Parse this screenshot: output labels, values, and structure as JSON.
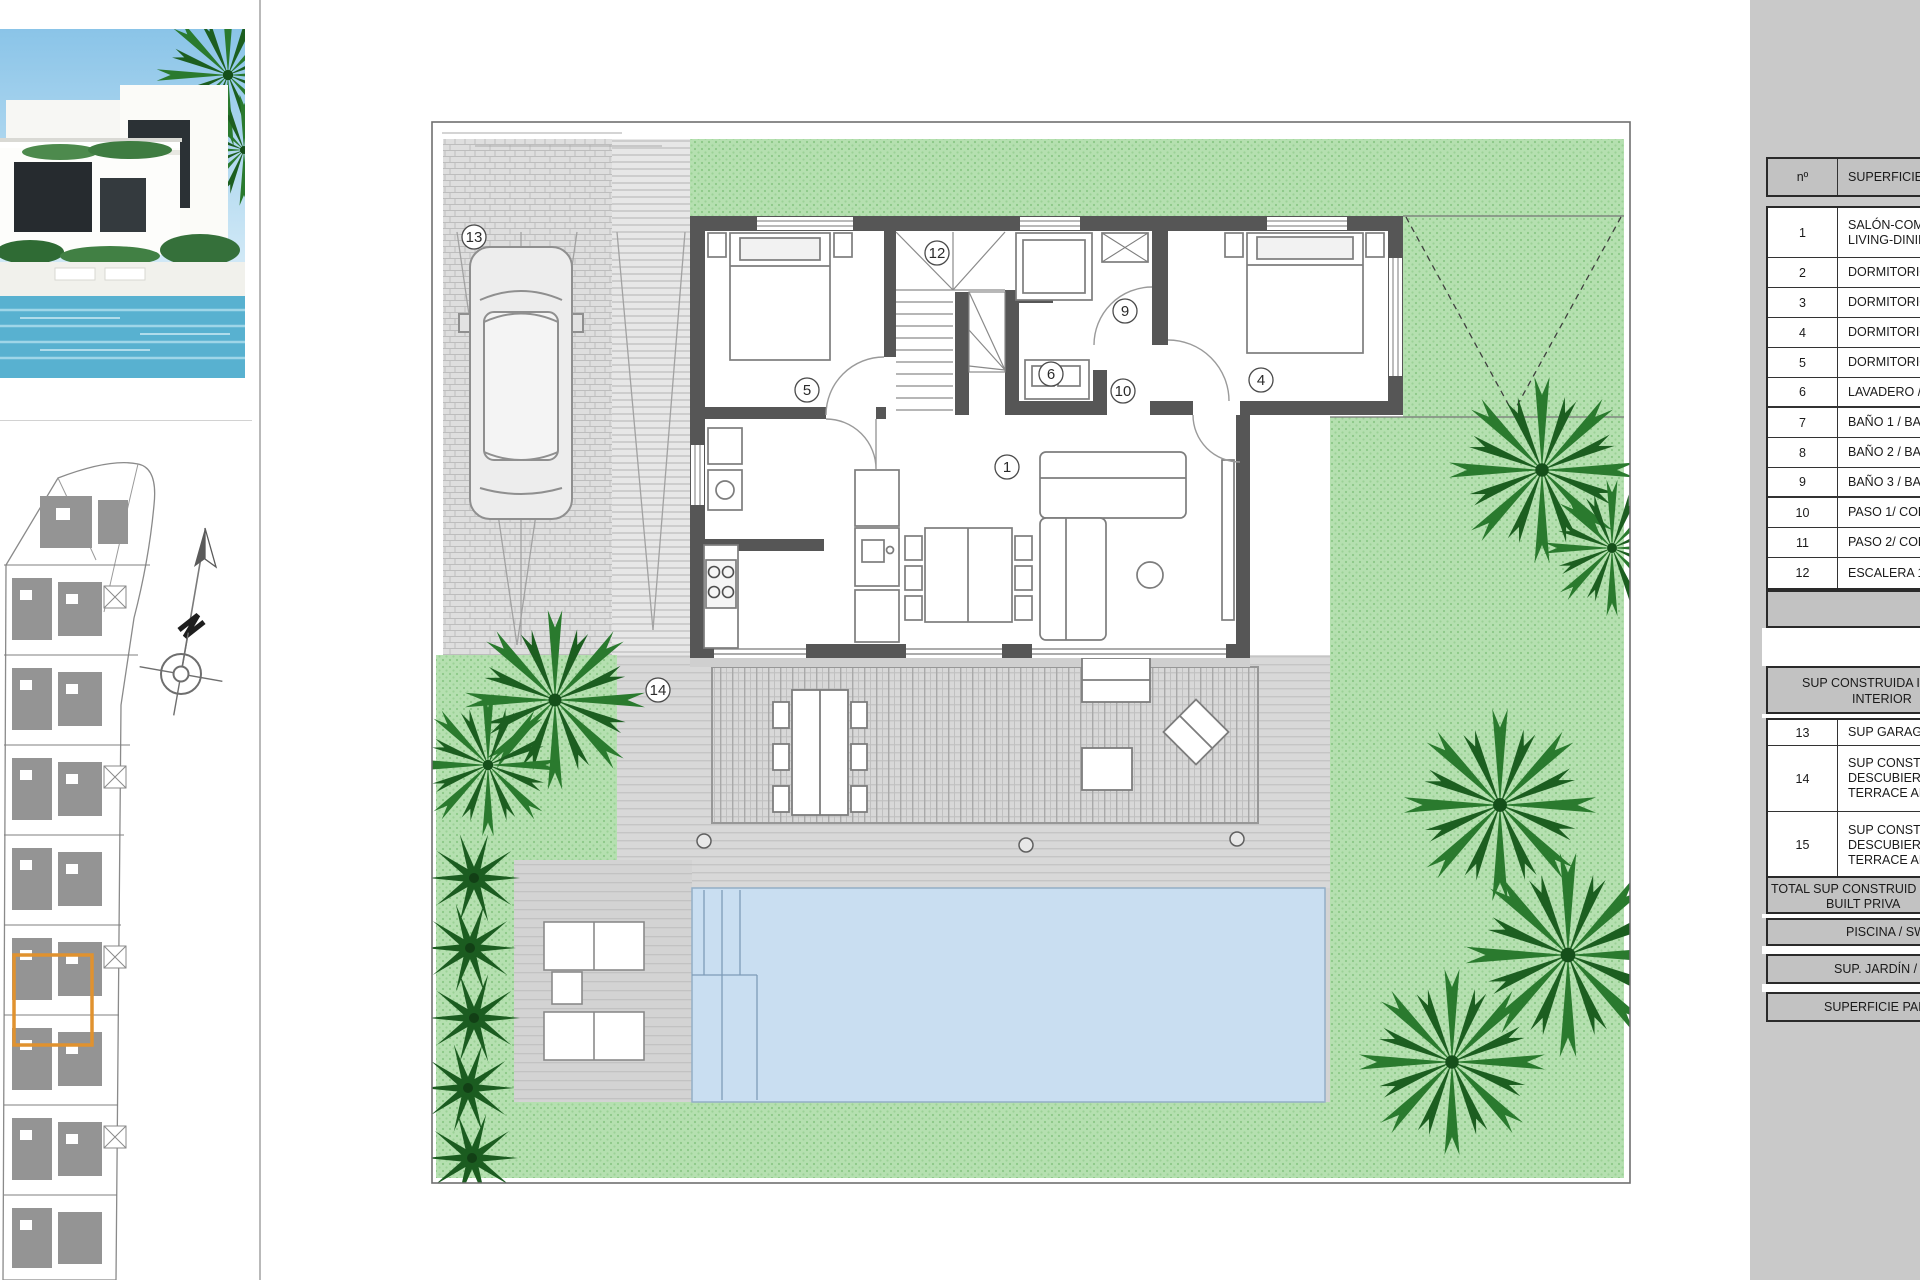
{
  "plan": {
    "labels": {
      "garage": "13",
      "stairs": "12",
      "bedroom_left": "5",
      "bathroom": "9",
      "laundry": "6",
      "hallway": "10",
      "bedroom_right": "4",
      "living": "1",
      "terrace": "14"
    }
  },
  "side_table": {
    "header": {
      "num": "nº",
      "title": "SUPERFICIE Ú"
    },
    "rooms": [
      {
        "num": "1",
        "line1": "SALÓN-COM",
        "line2": "LIVING-DININ"
      },
      {
        "num": "2",
        "line1": "DORMITORIO"
      },
      {
        "num": "3",
        "line1": "DORMITORIO"
      },
      {
        "num": "4",
        "line1": "DORMITORIO"
      },
      {
        "num": "5",
        "line1": "DORMITORIO"
      },
      {
        "num": "6",
        "line1": "LAVADERO /"
      },
      {
        "num": "7",
        "line1": "BAÑO 1 / BA"
      },
      {
        "num": "8",
        "line1": "BAÑO 2 / BA"
      },
      {
        "num": "9",
        "line1": "BAÑO 3 / BA"
      },
      {
        "num": "10",
        "line1": "PASO 1/ COR"
      },
      {
        "num": "11",
        "line1": "PASO 2/ COR"
      },
      {
        "num": "12",
        "line1": "ESCALERA 1 /"
      }
    ],
    "section": {
      "line1": "SUP CONSTRUIDA I",
      "line2": "INTERIOR"
    },
    "outdoor_rows": [
      {
        "num": "13",
        "line1": "SUP GARAGE"
      },
      {
        "num": "14",
        "line1": "SUP CONSTR",
        "line2": "DESCUBIERTA",
        "line3": "TERRACE ARE"
      },
      {
        "num": "15",
        "line1": "SUP CONSTR",
        "line2": "DESCUBIERTA",
        "line3": "TERRACE ARE"
      }
    ],
    "total": {
      "line1": "TOTAL SUP CONSTRUID",
      "line2": "BUILT PRIVA"
    },
    "footer_rows": [
      "PISCINA / SWIM",
      "SUP. JARDÍN / G",
      "SUPERFICIE PARCE"
    ]
  }
}
